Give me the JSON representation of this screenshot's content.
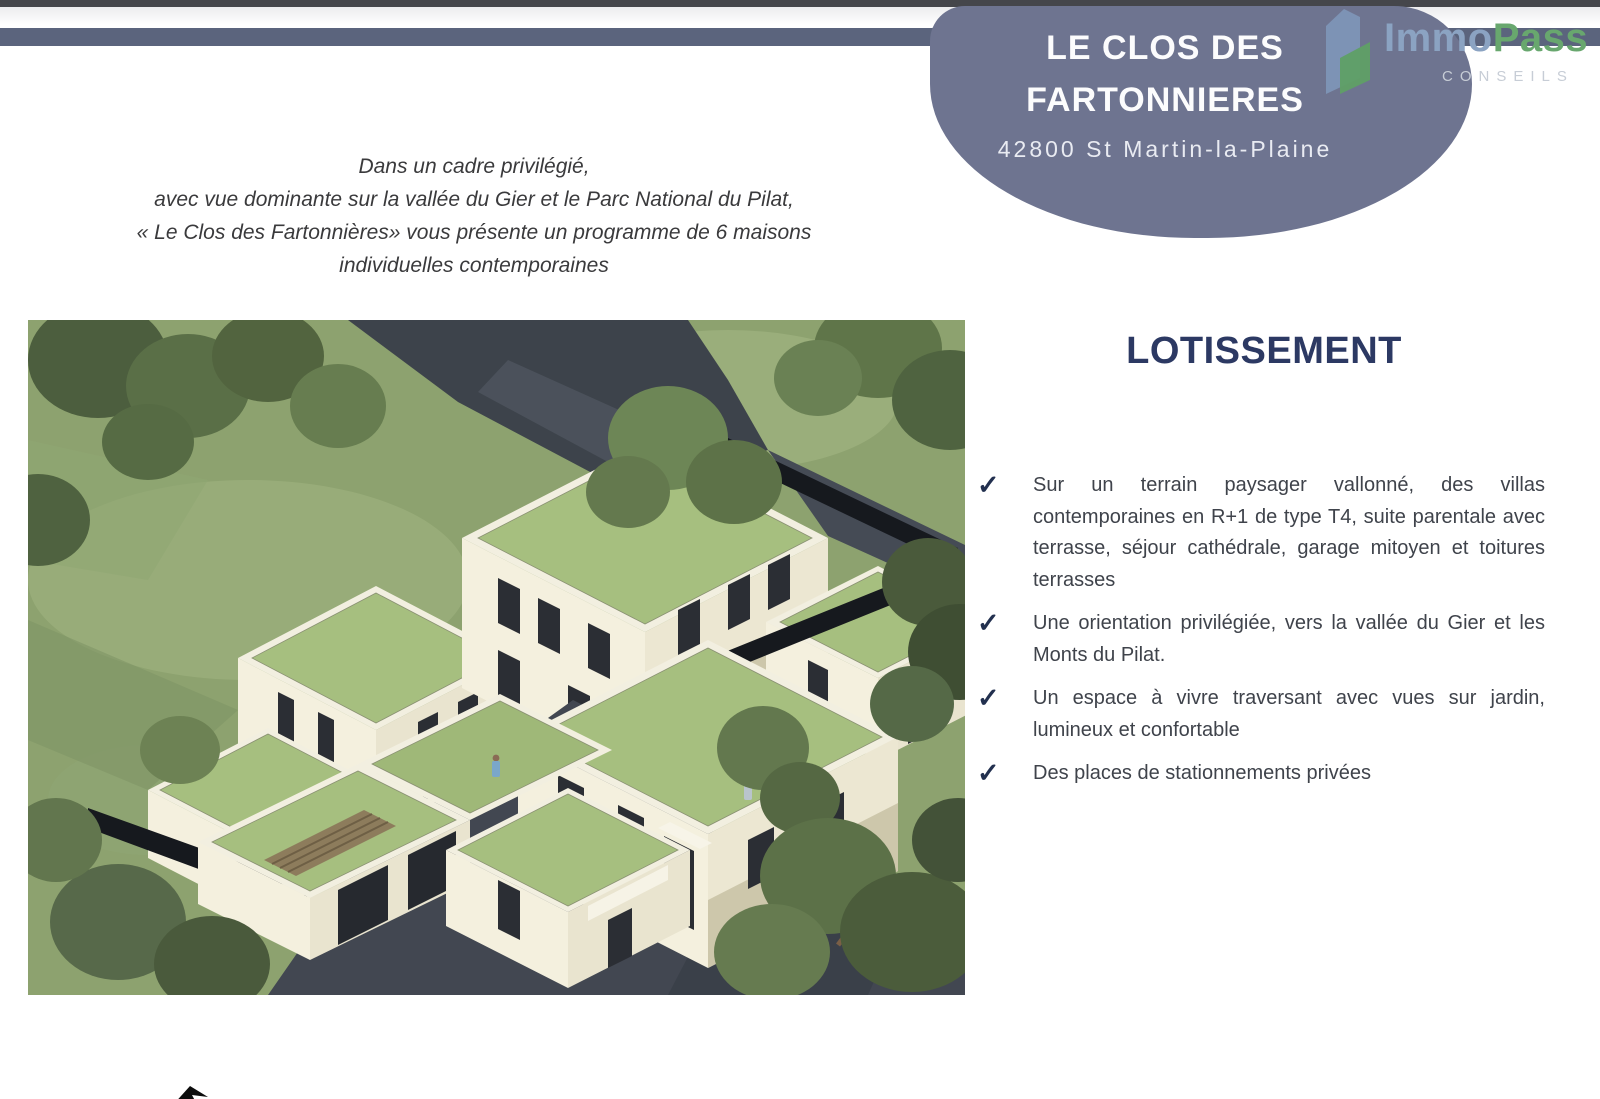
{
  "colors": {
    "topbar_dark": "#45464b",
    "band_slate": "#5b647d",
    "badge_slate": "#6e7490",
    "accent_navy": "#2c3963",
    "check_navy": "#22304f",
    "logo_blue": "#8ba3c2",
    "logo_green": "#68a76e",
    "logo_gray": "#c7cdd6",
    "roof_green": "#a6bf7f",
    "wall_cream": "#f3efdd"
  },
  "header": {
    "title_line1": "LE CLOS DES",
    "title_line2": "FARTONNIERES",
    "address": "42800 St Martin-la-Plaine"
  },
  "logo": {
    "part1": "Immo",
    "part2": "Pass",
    "subtitle": "CONSEILS"
  },
  "intro": {
    "line1": "Dans un cadre privilégié,",
    "line2": "avec vue dominante sur la vallée du Gier et le Parc National du Pilat,",
    "line3": "« Le Clos des Fartonnières» vous présente un programme de 6 maisons",
    "line4": "individuelles contemporaines"
  },
  "section": {
    "title": "LOTISSEMENT",
    "check_glyph": "✓",
    "bullets": [
      "Sur un terrain paysager vallonné, des villas contemporaines en R+1 de type T4, suite parentale avec terrasse, séjour cathédrale, garage mitoyen et toitures terrasses",
      "Une orientation privilégiée, vers la vallée du Gier et les Monts du Pilat.",
      "Un espace à vivre traversant avec vues sur jardin, lumineux et confortable",
      "Des places de stationnements privées"
    ]
  }
}
